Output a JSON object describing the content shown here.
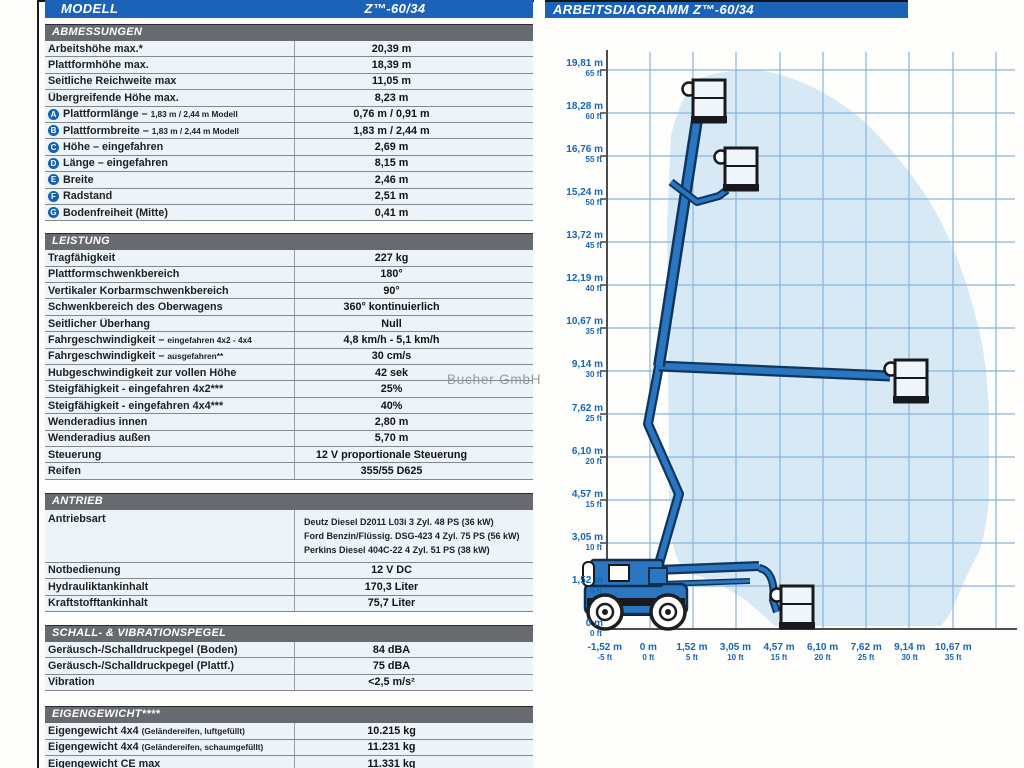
{
  "watermark": "Bucher GmbH",
  "model_bar": {
    "label": "MODELL",
    "value": "Z™-60/34"
  },
  "sections": {
    "abmessungen": {
      "title": "ABMESSUNGEN",
      "rows": [
        {
          "label": "Arbeitshöhe max.*",
          "value": "20,39 m"
        },
        {
          "label": "Plattformhöhe max.",
          "value": "18,39 m"
        },
        {
          "label": "Seitliche Reichweite max",
          "value": "11,05 m"
        },
        {
          "label": "Übergreifende Höhe max.",
          "value": "8,23 m"
        },
        {
          "badge": "A",
          "label": "Plattformlänge –",
          "small": "1,83 m / 2,44 m Modell",
          "value": "0,76 m / 0,91 m"
        },
        {
          "badge": "B",
          "label": "Plattformbreite –",
          "small": "1,83 m / 2,44 m Modell",
          "value": "1,83 m / 2,44 m"
        },
        {
          "badge": "C",
          "label": "Höhe – eingefahren",
          "value": "2,69 m"
        },
        {
          "badge": "D",
          "label": "Länge – eingefahren",
          "value": "8,15 m"
        },
        {
          "badge": "E",
          "label": "Breite",
          "value": "2,46 m"
        },
        {
          "badge": "F",
          "label": "Radstand",
          "value": "2,51 m"
        },
        {
          "badge": "G",
          "label": "Bodenfreiheit (Mitte)",
          "value": "0,41 m"
        }
      ]
    },
    "leistung": {
      "title": "LEISTUNG",
      "rows": [
        {
          "label": "Tragfähigkeit",
          "value": "227 kg"
        },
        {
          "label": "Plattformschwenkbereich",
          "value": "180°"
        },
        {
          "label": "Vertikaler Korbarmschwenkbereich",
          "value": "90°"
        },
        {
          "label": "Schwenkbereich des Oberwagens",
          "value": "360° kontinuierlich"
        },
        {
          "label": "Seitlicher Überhang",
          "value": "Null"
        },
        {
          "label": "Fahrgeschwindigkeit –",
          "small": "eingefahren 4x2 - 4x4",
          "value": "4,8 km/h - 5,1 km/h"
        },
        {
          "label": "Fahrgeschwindigkeit –",
          "small": "ausgefahren**",
          "value": "30 cm/s"
        },
        {
          "label": "Hubgeschwindigkeit zur vollen Höhe",
          "value": "42 sek"
        },
        {
          "label": "Steigfähigkeit - eingefahren 4x2***",
          "value": "25%"
        },
        {
          "label": "Steigfähigkeit - eingefahren 4x4***",
          "value": "40%"
        },
        {
          "label": "Wenderadius innen",
          "value": "2,80 m"
        },
        {
          "label": "Wenderadius außen",
          "value": "5,70 m"
        },
        {
          "label": "Steuerung",
          "value": "12 V proportionale Steuerung"
        },
        {
          "label": "Reifen",
          "value": "355/55 D625"
        }
      ]
    },
    "antrieb": {
      "title": "ANTRIEB",
      "drive_row": {
        "label": "Antriebsart",
        "lines": [
          "Deutz Diesel D2011 L03i 3 Zyl. 48 PS (36 kW)",
          "Ford Benzin/Flüssig. DSG-423 4 Zyl. 75 PS (56 kW)",
          "Perkins Diesel 404C-22 4 Zyl. 51 PS (38 kW)"
        ]
      },
      "rows": [
        {
          "label": "Notbedienung",
          "value": "12 V DC"
        },
        {
          "label": "Hydrauliktankinhalt",
          "value": "170,3 Liter"
        },
        {
          "label": "Kraftstofftankinhalt",
          "value": "75,7 Liter"
        }
      ]
    },
    "schall": {
      "title": "SCHALL- & VIBRATIONSPEGEL",
      "rows": [
        {
          "label": "Geräusch-/Schalldruckpegel (Boden)",
          "value": "84 dBA"
        },
        {
          "label": "Geräusch-/Schalldruckpegel (Plattf.)",
          "value": "75 dBA"
        },
        {
          "label": "Vibration",
          "value": "<2,5 m/s²"
        }
      ]
    },
    "eigengewicht": {
      "title": "EIGENGEWICHT****",
      "rows": [
        {
          "label": "Eigengewicht 4x4",
          "small": "(Geländereifen, luftgefüllt)",
          "value": "10.215 kg"
        },
        {
          "label": "Eigengewicht 4x4",
          "small": "(Geländereifen, schaumgefüllt)",
          "value": "11.231 kg"
        },
        {
          "label": "Eigengewicht CE max",
          "value": "11.331 kg"
        }
      ]
    }
  },
  "chart": {
    "title": "ARBEITSDIAGRAMM Z™-60/34",
    "y_ticks": [
      {
        "m": "19,81 m",
        "ft": "65 ft"
      },
      {
        "m": "18,28 m",
        "ft": "60 ft"
      },
      {
        "m": "16,76 m",
        "ft": "55 ft"
      },
      {
        "m": "15,24 m",
        "ft": "50 ft"
      },
      {
        "m": "13,72 m",
        "ft": "45 ft"
      },
      {
        "m": "12,19 m",
        "ft": "40 ft"
      },
      {
        "m": "10,67 m",
        "ft": "35 ft"
      },
      {
        "m": "9,14 m",
        "ft": "30 ft"
      },
      {
        "m": "7,62 m",
        "ft": "25 ft"
      },
      {
        "m": "6,10 m",
        "ft": "20 ft"
      },
      {
        "m": "4,57 m",
        "ft": "15 ft"
      },
      {
        "m": "3,05 m",
        "ft": "10 ft"
      },
      {
        "m": "1,52 m",
        "ft": "5 ft"
      },
      {
        "m": "0 m",
        "ft": "0 ft"
      }
    ],
    "x_ticks": [
      {
        "m": "-1,52 m",
        "ft": "-5 ft"
      },
      {
        "m": "0 m",
        "ft": "0 ft"
      },
      {
        "m": "1,52 m",
        "ft": "5 ft"
      },
      {
        "m": "3,05 m",
        "ft": "10 ft"
      },
      {
        "m": "4,57 m",
        "ft": "15 ft"
      },
      {
        "m": "6,10 m",
        "ft": "20 ft"
      },
      {
        "m": "7,62 m",
        "ft": "25 ft"
      },
      {
        "m": "9,14 m",
        "ft": "30 ft"
      },
      {
        "m": "10,67 m",
        "ft": "35 ft"
      }
    ]
  },
  "chart_data": {
    "type": "area",
    "title": "ARBEITSDIAGRAMM Z™-60/34",
    "x_axis": {
      "unit": "m / ft",
      "range_m": [
        -1.52,
        10.67
      ],
      "ticks_m": [
        -1.52,
        0,
        1.52,
        3.05,
        4.57,
        6.1,
        7.62,
        9.14,
        10.67
      ]
    },
    "y_axis": {
      "unit": "m / ft",
      "range_m": [
        0,
        19.81
      ],
      "ticks_m": [
        0,
        1.52,
        3.05,
        4.57,
        6.1,
        7.62,
        9.14,
        10.67,
        12.19,
        13.72,
        15.24,
        16.76,
        18.28,
        19.81
      ]
    },
    "envelope_outline_m": [
      [
        0.6,
        2.6
      ],
      [
        0.6,
        14.6
      ],
      [
        1.1,
        18.1
      ],
      [
        2.2,
        19.4
      ],
      [
        4.6,
        19.5
      ],
      [
        6.9,
        18.5
      ],
      [
        9.0,
        16.2
      ],
      [
        10.6,
        13.2
      ],
      [
        11.5,
        10.0
      ],
      [
        11.9,
        7.0
      ],
      [
        11.8,
        4.0
      ],
      [
        11.0,
        1.2
      ],
      [
        10.3,
        0.2
      ],
      [
        4.4,
        0.2
      ],
      [
        3.3,
        1.1
      ],
      [
        2.2,
        1.7
      ],
      [
        1.1,
        2.0
      ]
    ],
    "platform_positions_m": [
      [
        1.8,
        19.4
      ],
      [
        3.1,
        16.3
      ],
      [
        10.0,
        8.8
      ],
      [
        5.0,
        0.3
      ]
    ],
    "grid": true,
    "legend": false,
    "colors": {
      "envelope": "#d6e9f5",
      "grid": "#8ab4d8",
      "machine": "#2a76c0",
      "header_blue": "#1b63b8",
      "header_gray": "#676a6e"
    }
  }
}
